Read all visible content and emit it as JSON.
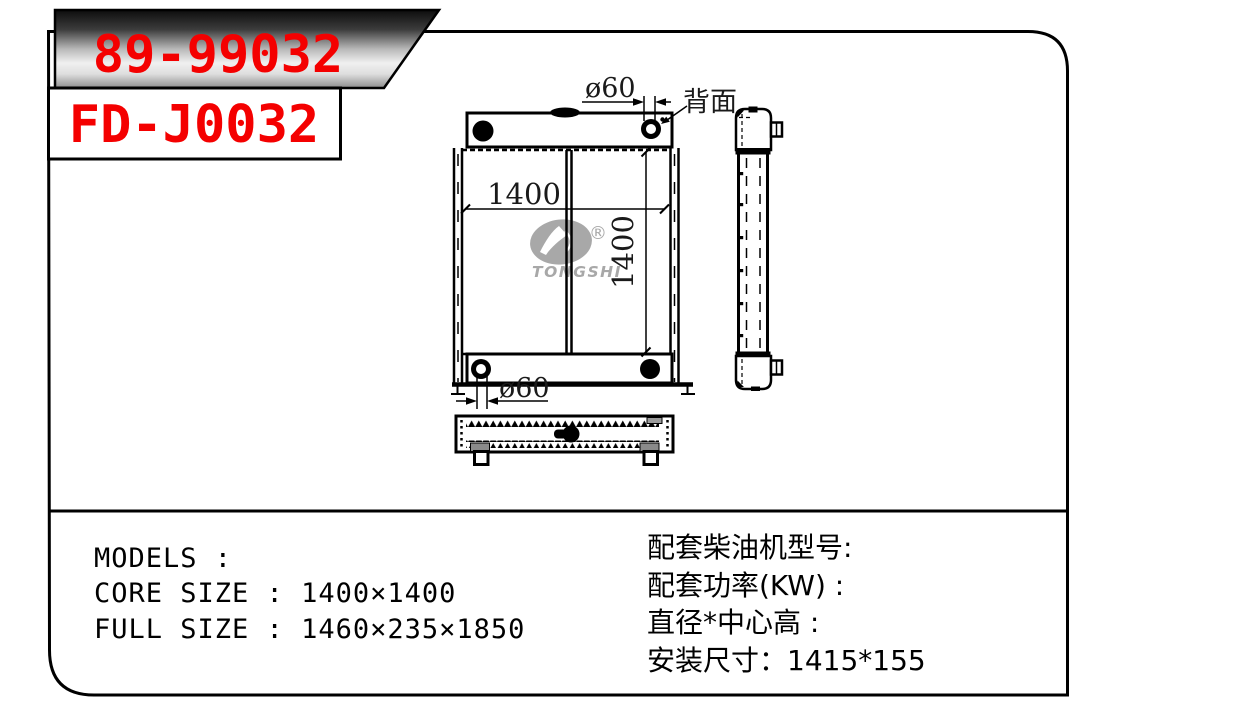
{
  "labels": {
    "part_number_primary": "89-99032",
    "part_number_secondary": "FD-J0032"
  },
  "drawing": {
    "top_pipe_diameter": "ø60",
    "back_view_label": "背面",
    "core_width_dim": "1400",
    "core_height_dim": "1400",
    "bottom_pipe_diameter": "ø60",
    "logo_brand": "TONGSHI",
    "logo_registered": "®"
  },
  "specs_left": {
    "models": "MODELS :",
    "core_size": "CORE SIZE : 1400×1400",
    "full_size": "FULL SIZE : 1460×235×1850"
  },
  "specs_right": {
    "engine_model": "配套柴油机型号:",
    "power_kw": "配套功率(KW) :",
    "diameter_center_height": "直径*中心高 :",
    "mounting_size": "安装尺寸：1415*155"
  },
  "colors": {
    "part_number_red": "#f40000",
    "line_black": "#000000",
    "logo_gray": "#a8a8a8"
  }
}
